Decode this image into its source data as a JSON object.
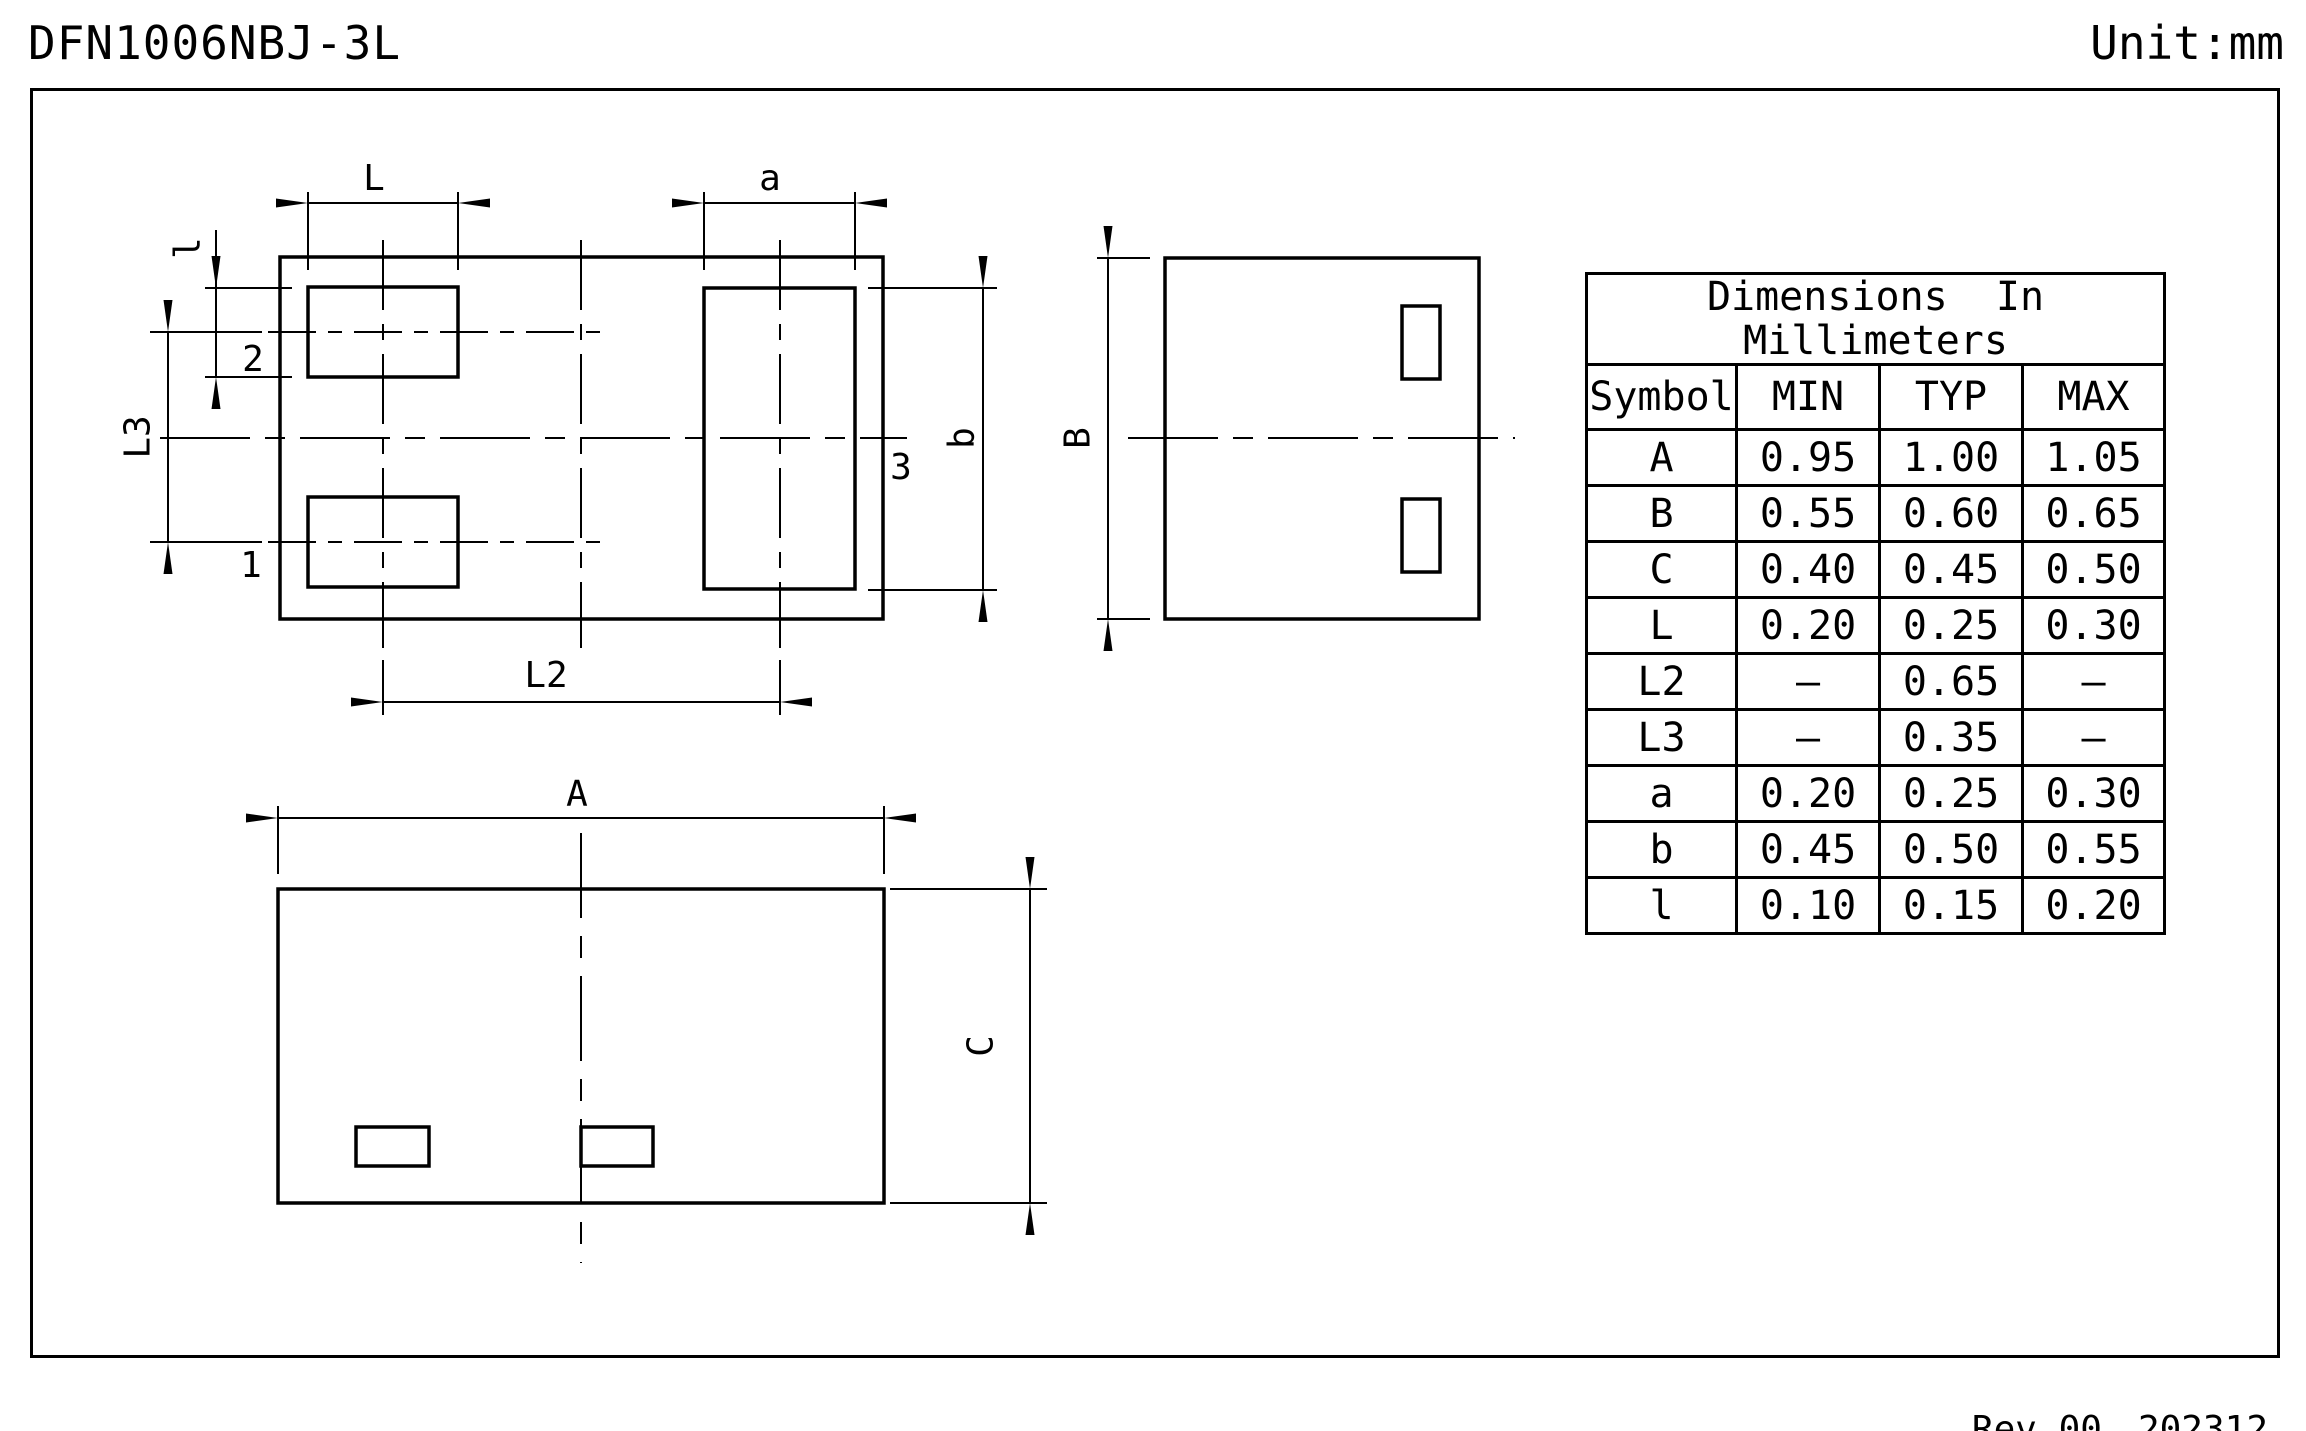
{
  "title": "DFN1006NBJ-3L",
  "unit": "Unit:mm",
  "footer": {
    "rev": "Rev.00",
    "date": "202312"
  },
  "table": {
    "title_line1": "Dimensions  In",
    "title_line2": "Millimeters",
    "columns": [
      "Symbol",
      "MIN",
      "TYP",
      "MAX"
    ],
    "rows": [
      {
        "symbol": "A",
        "min": "0.95",
        "typ": "1.00",
        "max": "1.05"
      },
      {
        "symbol": "B",
        "min": "0.55",
        "typ": "0.60",
        "max": "0.65"
      },
      {
        "symbol": "C",
        "min": "0.40",
        "typ": "0.45",
        "max": "0.50"
      },
      {
        "symbol": "L",
        "min": "0.20",
        "typ": "0.25",
        "max": "0.30"
      },
      {
        "symbol": "L2",
        "min": "–",
        "typ": "0.65",
        "max": "–"
      },
      {
        "symbol": "L3",
        "min": "–",
        "typ": "0.35",
        "max": "–"
      },
      {
        "symbol": "a",
        "min": "0.20",
        "typ": "0.25",
        "max": "0.30"
      },
      {
        "symbol": "b",
        "min": "0.45",
        "typ": "0.50",
        "max": "0.55"
      },
      {
        "symbol": "l",
        "min": "0.10",
        "typ": "0.15",
        "max": "0.20"
      }
    ]
  },
  "drawing": {
    "top_view": {
      "dim_L": "L",
      "dim_a": "a",
      "dim_l": "l",
      "dim_L3": "L3",
      "dim_L2": "L2",
      "dim_b": "b",
      "pin1": "1",
      "pin2": "2",
      "pin3": "3"
    },
    "side_view": {
      "dim_B": "B"
    },
    "bottom_view": {
      "dim_A": "A",
      "dim_C": "C"
    }
  }
}
